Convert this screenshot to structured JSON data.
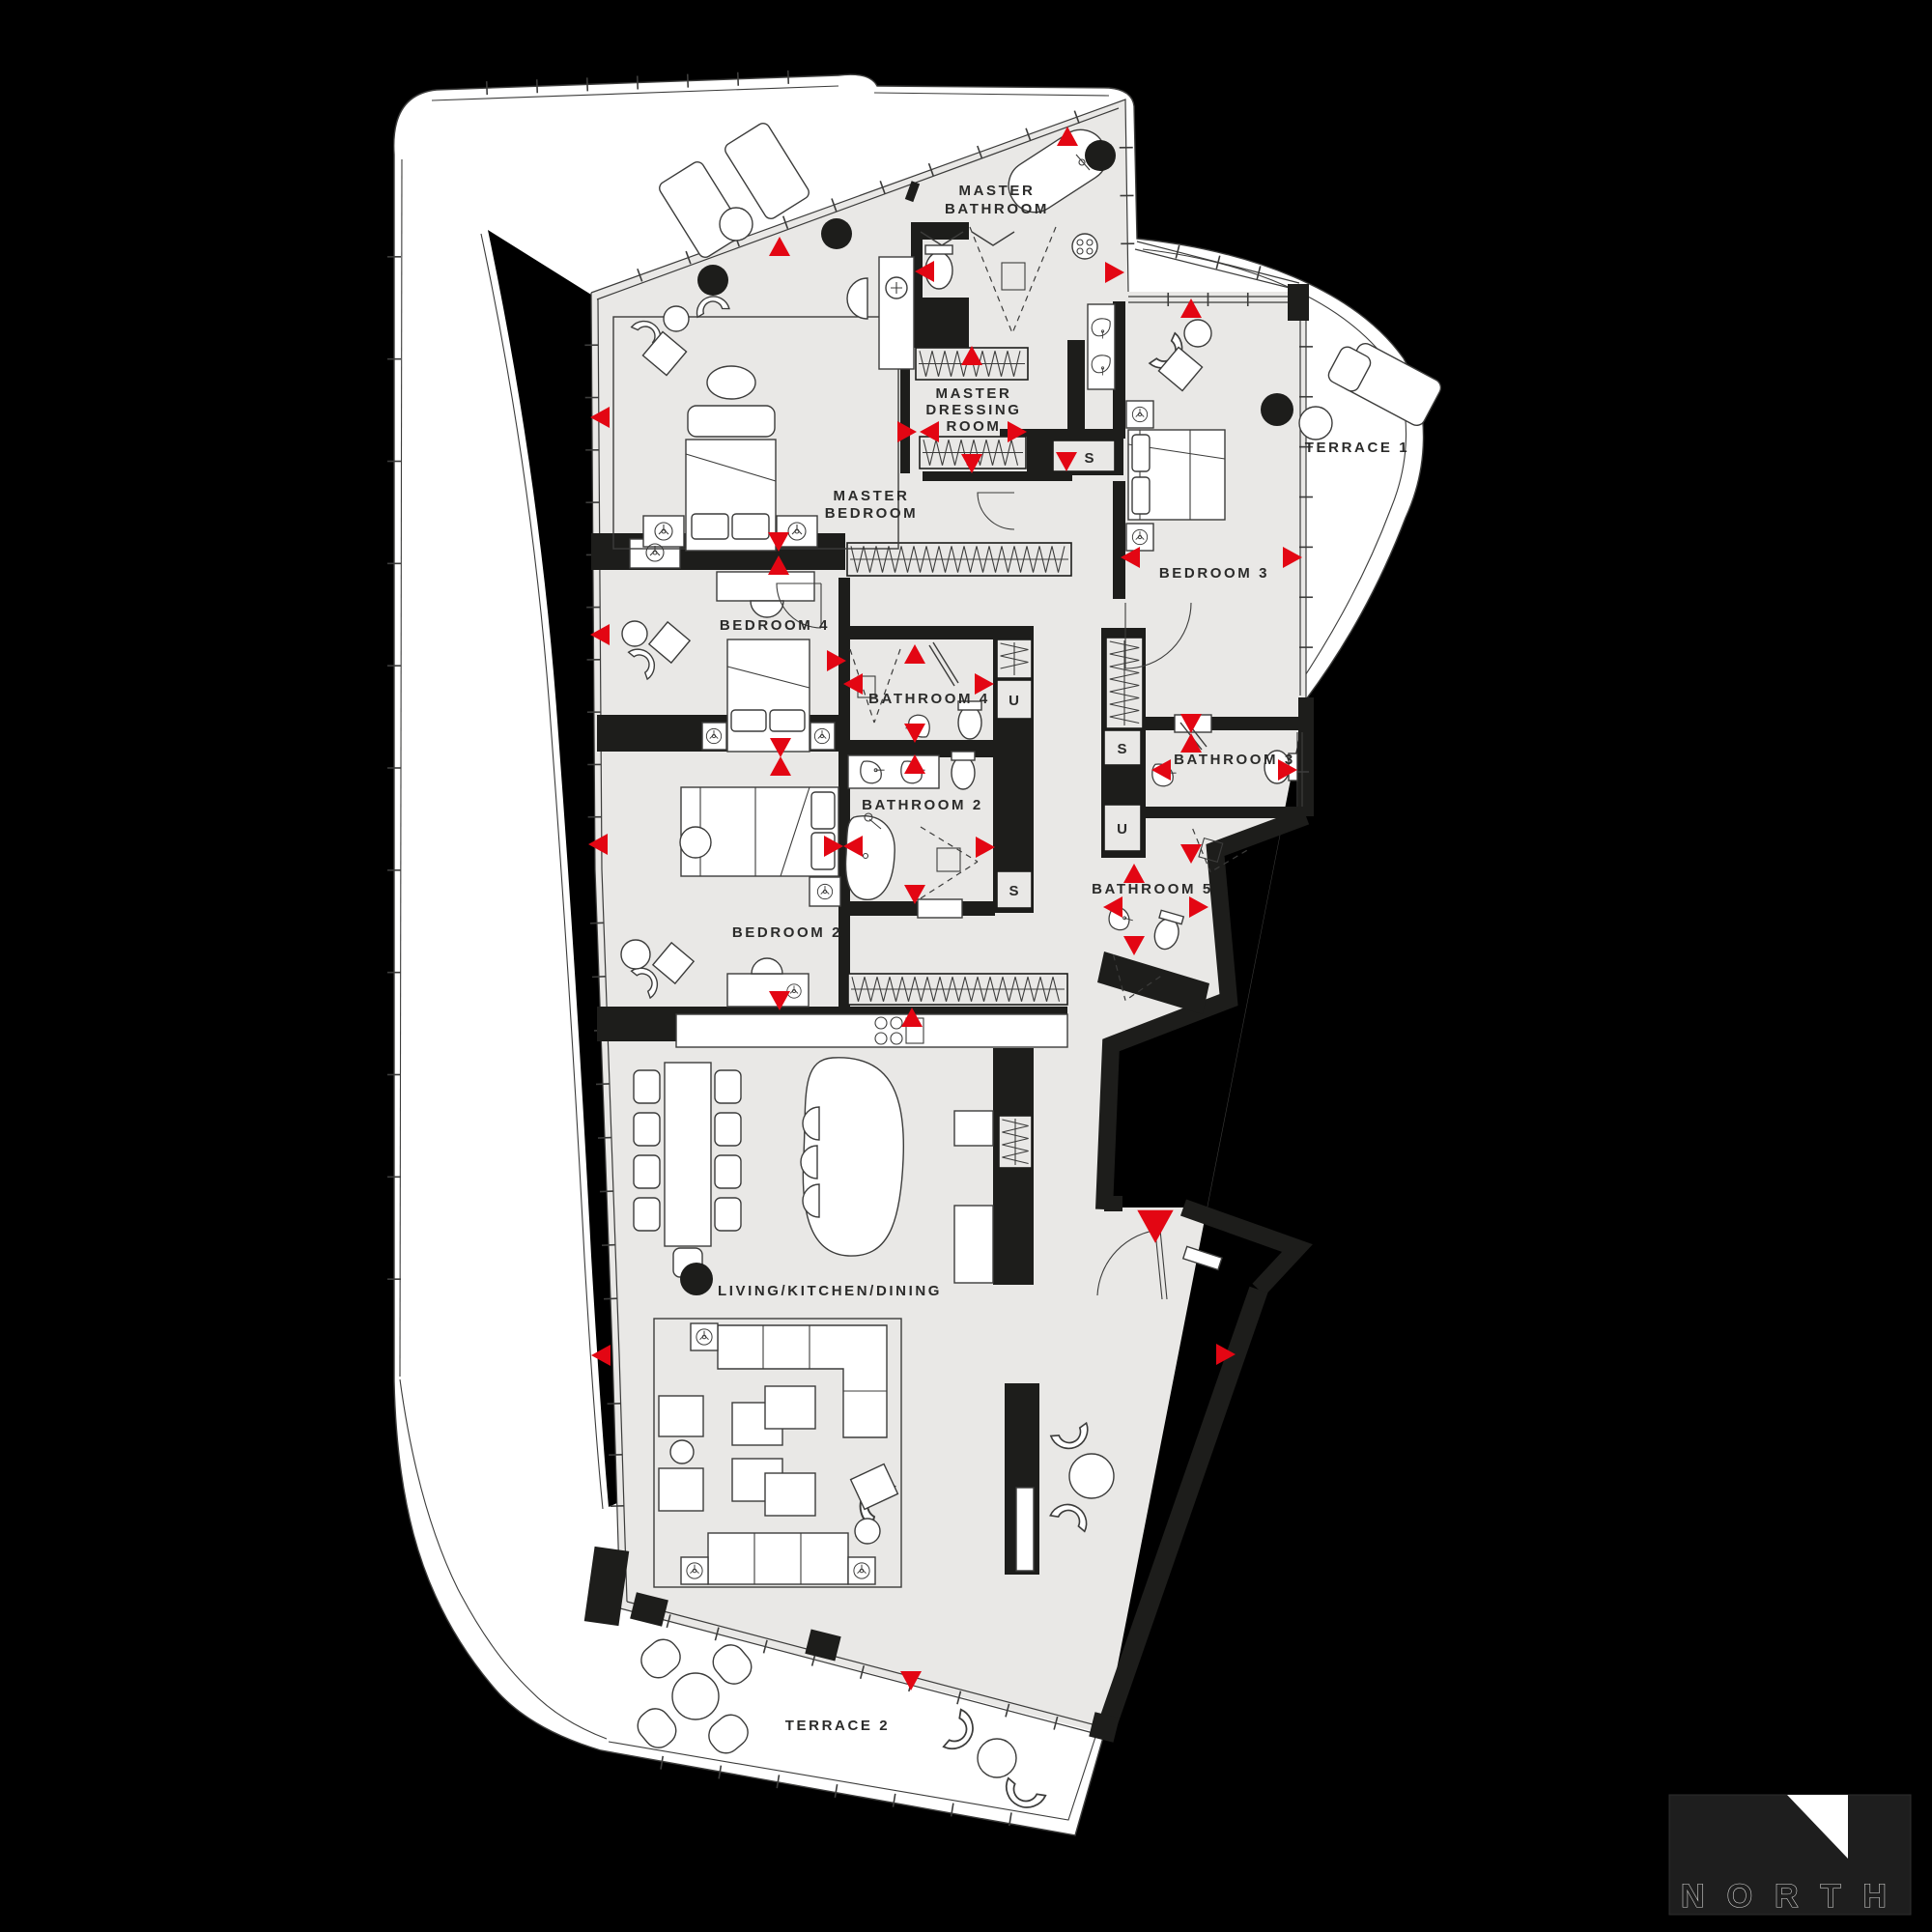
{
  "plan": {
    "rooms": {
      "master_bathroom": {
        "lines": [
          "MASTER",
          "BATHROOM"
        ]
      },
      "master_dressing_room": {
        "lines": [
          "MASTER",
          "DRESSING",
          "ROOM"
        ]
      },
      "master_bedroom": {
        "lines": [
          "MASTER",
          "BEDROOM"
        ]
      },
      "bedroom_4": {
        "lines": [
          "BEDROOM 4"
        ]
      },
      "bathroom_4": {
        "lines": [
          "BATHROOM 4"
        ]
      },
      "bathroom_2": {
        "lines": [
          "BATHROOM 2"
        ]
      },
      "bedroom_2": {
        "lines": [
          "BEDROOM 2"
        ]
      },
      "bedroom_3": {
        "lines": [
          "BEDROOM 3"
        ]
      },
      "terrace_1": {
        "lines": [
          "TERRACE 1"
        ]
      },
      "bathroom_3": {
        "lines": [
          "BATHROOM 3"
        ]
      },
      "bathroom_5": {
        "lines": [
          "BATHROOM 5"
        ]
      },
      "living_kitchen_dining": {
        "lines": [
          "LIVING/KITCHEN/DINING"
        ]
      },
      "terrace_2": {
        "lines": [
          "TERRACE 2"
        ]
      }
    },
    "storage_labels": {
      "s": "S",
      "u": "U"
    },
    "colors": {
      "background": "#000000",
      "apartment_fill": "#e9e8e6",
      "terrace_fill": "#ffffff",
      "wall": "#1d1d1b",
      "marker_red": "#e30613",
      "line": "#3c3c3b"
    }
  },
  "logo": {
    "text": "NORTH"
  }
}
